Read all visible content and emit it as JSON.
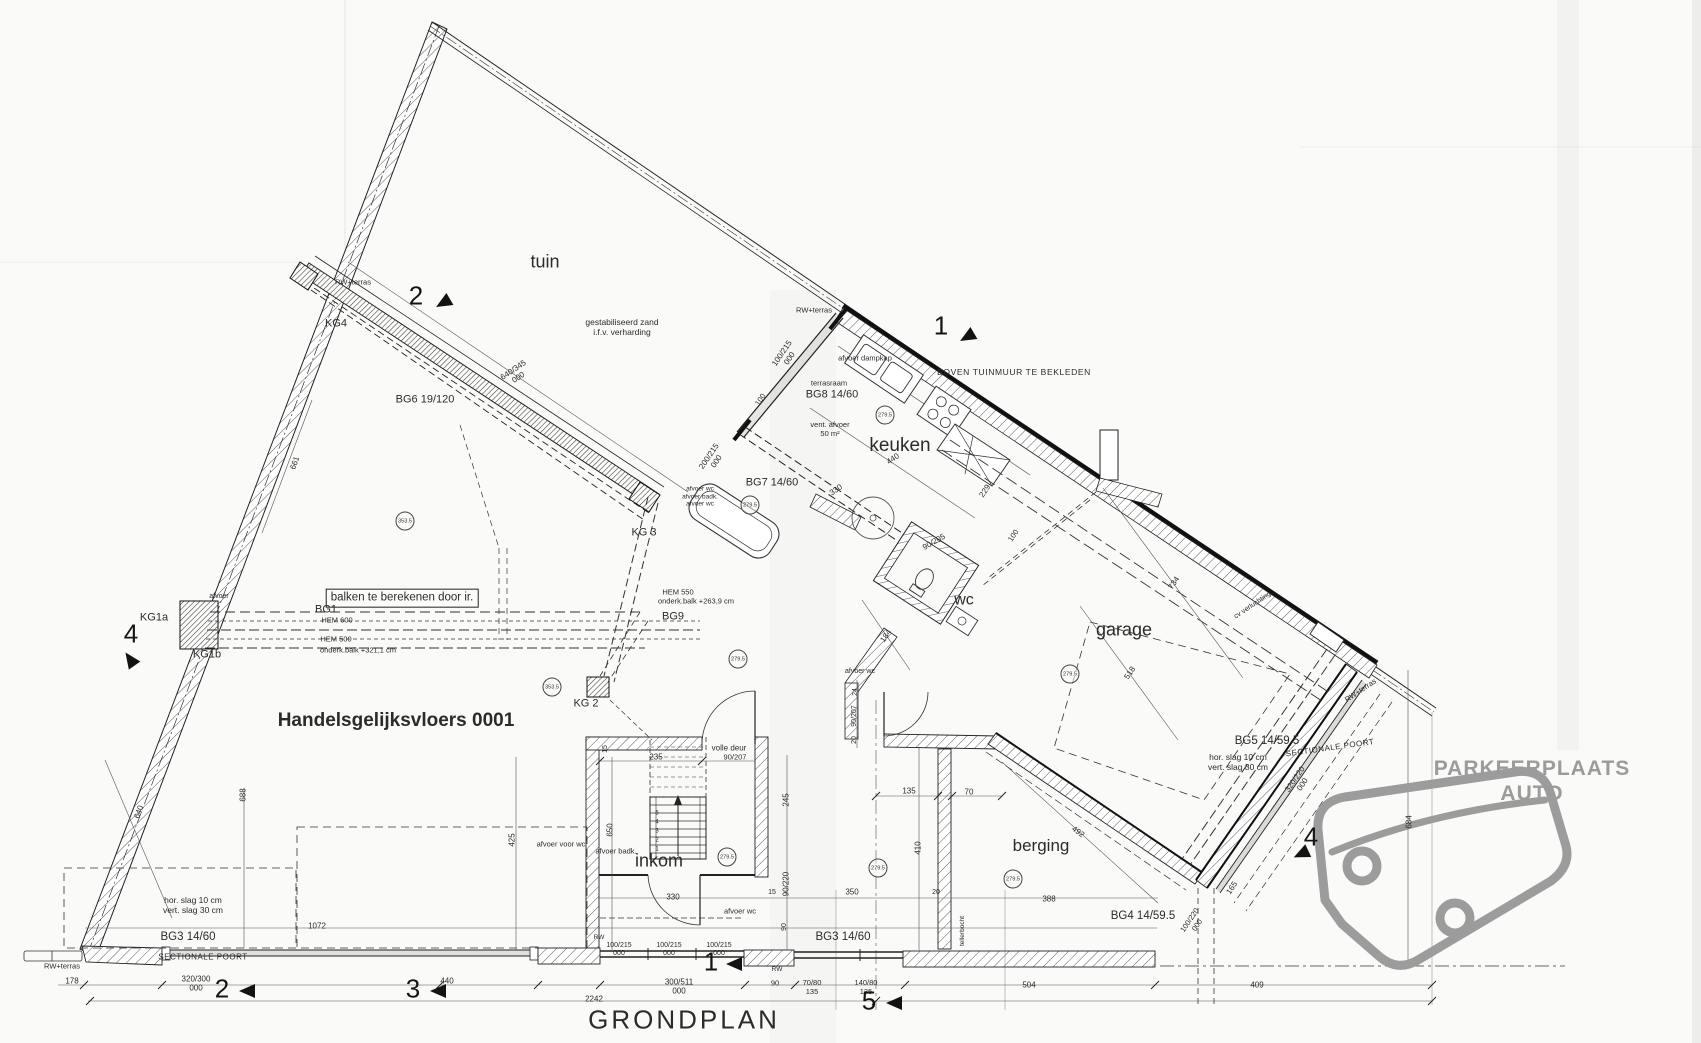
{
  "colors": {
    "ink": "#2a2a2a",
    "gray_text": "#9b9b9b",
    "paper": "#fafaf8",
    "car_outline": "#9c9c9c"
  },
  "labels": [
    {
      "n": "room-label-tuin",
      "t": "tuin",
      "x": 545,
      "y": 262,
      "s": 18
    },
    {
      "n": "room-label-keuken",
      "t": "keuken",
      "x": 900,
      "y": 446,
      "s": 19
    },
    {
      "n": "room-label-wc",
      "t": "wc",
      "x": 964,
      "y": 601,
      "s": 16
    },
    {
      "n": "room-label-garage",
      "t": "garage",
      "x": 1124,
      "y": 630,
      "s": 18
    },
    {
      "n": "room-label-berging",
      "t": "berging",
      "x": 1041,
      "y": 846,
      "s": 17
    },
    {
      "n": "room-label-inkom",
      "t": "inkom",
      "x": 659,
      "y": 861,
      "s": 18
    },
    {
      "n": "floor-title",
      "t": "Handelsgelijksvloers 0001",
      "x": 396,
      "y": 721,
      "s": 19,
      "w": 700
    },
    {
      "n": "plan-title",
      "t": "GRONDPLAN",
      "x": 684,
      "y": 1020,
      "s": 26,
      "ls": 3
    },
    {
      "n": "parking-label",
      "t": "PARKEERPLAATS AUTO",
      "x": 1532,
      "y": 782,
      "s": 21,
      "w": 700,
      "c": "#9b9b9b",
      "ls": 1
    },
    {
      "n": "note-gestabiliseerd-zand",
      "t": "gestabiliseerd zand\ni.f.v. verharding",
      "x": 622,
      "y": 327,
      "s": 8.5
    },
    {
      "n": "note-tuinmuur",
      "t": "BOVEN TUINMUUR TE BEKLEDEN",
      "x": 1014,
      "y": 372,
      "s": 8.5,
      "ls": 0.6
    },
    {
      "n": "note-balken",
      "t": "balken te berekenen door ir.",
      "x": 402,
      "y": 598,
      "s": 11.5,
      "box": true
    },
    {
      "n": "note-slag-left",
      "t": "hor. slag 10 cm\nvert. slag 30 cm",
      "x": 193,
      "y": 905,
      "s": 8.5
    },
    {
      "n": "note-slag-right",
      "t": "hor. slag 10 cm\nvert. slag 30 cm",
      "x": 1238,
      "y": 762,
      "s": 8.5
    },
    {
      "n": "note-volle-deur",
      "t": "volle deur",
      "x": 729,
      "y": 748,
      "s": 8
    },
    {
      "n": "note-onderkant-balk-1",
      "t": "onderk.balk +321,1 cm",
      "x": 358,
      "y": 651,
      "s": 7.5
    },
    {
      "n": "note-onderkant-balk-2",
      "t": "onderk.balk +263,9 cm",
      "x": 696,
      "y": 602,
      "s": 7.5
    },
    {
      "n": "beam-hem600",
      "t": "HEM 600",
      "x": 337,
      "y": 621,
      "s": 7.5
    },
    {
      "n": "beam-hem500",
      "t": "HEM 500",
      "x": 336,
      "y": 640,
      "s": 7.5
    },
    {
      "n": "beam-hem550",
      "t": "HEM 550",
      "x": 678,
      "y": 593,
      "s": 7.5
    },
    {
      "n": "note-sectionale-poort-left",
      "t": "SECTIONALE POORT",
      "x": 203,
      "y": 957,
      "s": 8,
      "ls": 0.5
    },
    {
      "n": "note-sectionale-poort-right",
      "t": "SECTIONALE POORT",
      "x": 1330,
      "y": 748,
      "s": 8,
      "r": -8,
      "ls": 0.5
    },
    {
      "n": "note-tellerbocht",
      "t": "tellerbocht",
      "x": 963,
      "y": 931,
      "s": 6.5,
      "r": -90
    },
    {
      "n": "note-cv-verluchting",
      "t": "cv verluchting",
      "x": 1253,
      "y": 606,
      "s": 7,
      "r": -34
    },
    {
      "n": "note-rw-terras-1",
      "t": "RW+terras",
      "x": 353,
      "y": 283,
      "s": 7.5
    },
    {
      "n": "note-rw-terras-2",
      "t": "RW+terras",
      "x": 814,
      "y": 311,
      "s": 7.5
    },
    {
      "n": "note-rw-terras-3",
      "t": "RW+terras",
      "x": 62,
      "y": 967,
      "s": 7.5
    },
    {
      "n": "note-rw-terras-4",
      "t": "RW+terras",
      "x": 1361,
      "y": 691,
      "s": 7.5,
      "r": -34
    },
    {
      "n": "note-rw-1",
      "t": "RW",
      "x": 599,
      "y": 938,
      "s": 6.5
    },
    {
      "n": "note-rw-2",
      "t": "RW",
      "x": 777,
      "y": 970,
      "s": 6.5
    },
    {
      "n": "column-kg4",
      "t": "KG4",
      "x": 336,
      "y": 324,
      "s": 11
    },
    {
      "n": "column-kg3",
      "t": "KG 3",
      "x": 644,
      "y": 533,
      "s": 11
    },
    {
      "n": "column-kg2",
      "t": "KG 2",
      "x": 586,
      "y": 704,
      "s": 11
    },
    {
      "n": "column-kg1a",
      "t": "KG1a",
      "x": 154,
      "y": 618,
      "s": 11
    },
    {
      "n": "column-kg1b",
      "t": "KG1b",
      "x": 207,
      "y": 655,
      "s": 11
    },
    {
      "n": "beam-bg6",
      "t": "BG6 19/120",
      "x": 425,
      "y": 400,
      "s": 11
    },
    {
      "n": "beam-bg7",
      "t": "BG7 14/60",
      "x": 772,
      "y": 483,
      "s": 11
    },
    {
      "n": "beam-bg8",
      "t": "BG8 14/60",
      "x": 832,
      "y": 395,
      "s": 11
    },
    {
      "n": "beam-bg1",
      "t": "BG1",
      "x": 326,
      "y": 610,
      "s": 11
    },
    {
      "n": "beam-bg9",
      "t": "BG9",
      "x": 673,
      "y": 617,
      "s": 11
    },
    {
      "n": "beam-bg3-left",
      "t": "BG3 14/60",
      "x": 188,
      "y": 938,
      "s": 11.5
    },
    {
      "n": "beam-bg3-mid",
      "t": "BG3 14/60",
      "x": 843,
      "y": 938,
      "s": 11.5
    },
    {
      "n": "beam-bg4",
      "t": "BG4 14/59.5",
      "x": 1143,
      "y": 917,
      "s": 11.5
    },
    {
      "n": "beam-bg5",
      "t": "BG5 14/59.5",
      "x": 1267,
      "y": 742,
      "s": 11.5
    },
    {
      "n": "note-afvoer-dampkap",
      "t": "afvoer dampkap",
      "x": 865,
      "y": 359,
      "s": 7.5
    },
    {
      "n": "note-terrasraam",
      "t": "terrasraam",
      "x": 829,
      "y": 384,
      "s": 7.5
    },
    {
      "n": "note-vent-afvoer",
      "t": "vent. afvoer\n50 m²",
      "x": 830,
      "y": 430,
      "s": 7.5
    },
    {
      "n": "note-afvoer-kg1",
      "t": "afvoer",
      "x": 219,
      "y": 597,
      "s": 7
    },
    {
      "n": "note-afvoer-voor-wc",
      "t": "afvoer voor wc",
      "x": 561,
      "y": 845,
      "s": 7.5
    },
    {
      "n": "note-afvoer-badk",
      "t": "afvoer badk.",
      "x": 616,
      "y": 852,
      "s": 7.5
    },
    {
      "n": "note-afvoer-wc-1",
      "t": "afvoer wc",
      "x": 740,
      "y": 912,
      "s": 7.5
    },
    {
      "n": "note-afvoer-wc-2",
      "t": "afvoer wc",
      "x": 860,
      "y": 672,
      "s": 7
    },
    {
      "n": "note-afvoer-stack",
      "t": "afvoer wc\nafvoer badk.\nafvoer wc",
      "x": 700,
      "y": 497,
      "s": 6.5
    },
    {
      "n": "dim-640-345",
      "t": "640/345\n000",
      "x": 516,
      "y": 374,
      "s": 8,
      "r": -34
    },
    {
      "n": "dim-100-215-top",
      "t": "100/215\n000",
      "x": 786,
      "y": 356,
      "s": 8,
      "r": -56
    },
    {
      "n": "dim-100-a",
      "t": "100",
      "x": 761,
      "y": 400,
      "s": 7.5,
      "r": -56
    },
    {
      "n": "dim-200-215",
      "t": "200/215\n000",
      "x": 713,
      "y": 459,
      "s": 8,
      "r": -56
    },
    {
      "n": "dim-440-keuken",
      "t": "440",
      "x": 893,
      "y": 459,
      "s": 8,
      "r": -34
    },
    {
      "n": "dim-330-keuken",
      "t": "330",
      "x": 836,
      "y": 490,
      "s": 8,
      "r": -34
    },
    {
      "n": "dim-330-inkom",
      "t": "330",
      "x": 673,
      "y": 897,
      "s": 8
    },
    {
      "n": "dim-229",
      "t": "229",
      "x": 985,
      "y": 491,
      "s": 8,
      "r": -56
    },
    {
      "n": "dim-100-b",
      "t": "100",
      "x": 1014,
      "y": 536,
      "s": 7.5,
      "r": -56
    },
    {
      "n": "dim-90-205",
      "t": "90/205",
      "x": 934,
      "y": 542,
      "s": 8,
      "r": -30
    },
    {
      "n": "dim-184",
      "t": "184",
      "x": 886,
      "y": 636,
      "s": 8,
      "r": -56
    },
    {
      "n": "dim-734",
      "t": "734",
      "x": 1174,
      "y": 583,
      "s": 8,
      "r": -56
    },
    {
      "n": "dim-518",
      "t": "518",
      "x": 1130,
      "y": 673,
      "s": 8,
      "r": -56
    },
    {
      "n": "dim-492",
      "t": "492",
      "x": 1078,
      "y": 832,
      "s": 8,
      "r": 36
    },
    {
      "n": "dim-165",
      "t": "165",
      "x": 1232,
      "y": 888,
      "s": 8,
      "r": -56
    },
    {
      "n": "dim-100-220",
      "t": "100/220\n000",
      "x": 1194,
      "y": 923,
      "s": 7.5,
      "r": -56
    },
    {
      "n": "dim-320-220",
      "t": "320/220\n000",
      "x": 1299,
      "y": 782,
      "s": 8,
      "r": -56
    },
    {
      "n": "dim-684",
      "t": "684",
      "x": 1409,
      "y": 822,
      "s": 8,
      "r": -90
    },
    {
      "n": "dim-661",
      "t": "661",
      "x": 295,
      "y": 463,
      "s": 8,
      "r": -70
    },
    {
      "n": "dim-640",
      "t": "640",
      "x": 139,
      "y": 812,
      "s": 8,
      "r": -70
    },
    {
      "n": "dim-688",
      "t": "688",
      "x": 243,
      "y": 795,
      "s": 8,
      "r": -90
    },
    {
      "n": "dim-425",
      "t": "425",
      "x": 512,
      "y": 840,
      "s": 8,
      "r": -90
    },
    {
      "n": "dim-650",
      "t": "650",
      "x": 610,
      "y": 830,
      "s": 8,
      "r": -90
    },
    {
      "n": "dim-245",
      "t": "245",
      "x": 786,
      "y": 800,
      "s": 8,
      "r": -90
    },
    {
      "n": "dim-90-220",
      "t": "90/220",
      "x": 786,
      "y": 884,
      "s": 8,
      "r": -90
    },
    {
      "n": "dim-90-c",
      "t": "90",
      "x": 785,
      "y": 927,
      "s": 7,
      "r": -90
    },
    {
      "n": "dim-15-a",
      "t": "15",
      "x": 772,
      "y": 893,
      "s": 7
    },
    {
      "n": "dim-15-b",
      "t": "15",
      "x": 606,
      "y": 749,
      "s": 7,
      "r": -90
    },
    {
      "n": "dim-235",
      "t": "235",
      "x": 656,
      "y": 757,
      "s": 8
    },
    {
      "n": "dim-90-207-deur",
      "t": "90/207",
      "x": 735,
      "y": 758,
      "s": 7.5
    },
    {
      "n": "dim-410",
      "t": "410",
      "x": 918,
      "y": 848,
      "s": 8,
      "r": -90
    },
    {
      "n": "dim-350",
      "t": "350",
      "x": 852,
      "y": 892,
      "s": 8
    },
    {
      "n": "dim-20-a",
      "t": "20",
      "x": 936,
      "y": 893,
      "s": 7
    },
    {
      "n": "dim-388",
      "t": "388",
      "x": 1049,
      "y": 899,
      "s": 8
    },
    {
      "n": "dim-135",
      "t": "135",
      "x": 909,
      "y": 791,
      "s": 8
    },
    {
      "n": "dim-70",
      "t": "70",
      "x": 969,
      "y": 792,
      "s": 8
    },
    {
      "n": "dim-24",
      "t": "24",
      "x": 856,
      "y": 692,
      "s": 7,
      "r": -90
    },
    {
      "n": "dim-90-207-side",
      "t": "90/207",
      "x": 855,
      "y": 716,
      "s": 7,
      "r": -90
    },
    {
      "n": "dim-20-b",
      "t": "20",
      "x": 855,
      "y": 740,
      "s": 7,
      "r": -90
    },
    {
      "n": "dim-1072",
      "t": "1072",
      "x": 317,
      "y": 926,
      "s": 8
    },
    {
      "n": "dim-178",
      "t": "178",
      "x": 72,
      "y": 981,
      "s": 8
    },
    {
      "n": "dim-320-300",
      "t": "320/300\n000",
      "x": 196,
      "y": 984,
      "s": 8
    },
    {
      "n": "dim-440-b",
      "t": "440",
      "x": 447,
      "y": 981,
      "s": 8
    },
    {
      "n": "dim-300-511",
      "t": "300/511\n000",
      "x": 679,
      "y": 987,
      "s": 8
    },
    {
      "n": "dim-90-d",
      "t": "90",
      "x": 775,
      "y": 984,
      "s": 7.5
    },
    {
      "n": "dim-70-80",
      "t": "70/80\n135",
      "x": 812,
      "y": 988,
      "s": 7.5
    },
    {
      "n": "dim-140-80",
      "t": "140/80\n135",
      "x": 866,
      "y": 988,
      "s": 7.5
    },
    {
      "n": "dim-504",
      "t": "504",
      "x": 1029,
      "y": 985,
      "s": 8
    },
    {
      "n": "dim-409",
      "t": "409",
      "x": 1257,
      "y": 985,
      "s": 8
    },
    {
      "n": "dim-2242",
      "t": "2242",
      "x": 594,
      "y": 999,
      "s": 8
    },
    {
      "n": "dim-100-215-w1",
      "t": "100/215\n000",
      "x": 619,
      "y": 950,
      "s": 7
    },
    {
      "n": "dim-100-215-w2",
      "t": "100/215\n000",
      "x": 669,
      "y": 950,
      "s": 7
    },
    {
      "n": "dim-100-215-w3",
      "t": "100/215\n000",
      "x": 719,
      "y": 950,
      "s": 7
    },
    {
      "n": "stair-step-1",
      "t": "1",
      "x": 657,
      "y": 850,
      "s": 6
    },
    {
      "n": "stair-step-2",
      "t": "2",
      "x": 657,
      "y": 841,
      "s": 6
    },
    {
      "n": "stair-step-3",
      "t": "3",
      "x": 657,
      "y": 832,
      "s": 6
    },
    {
      "n": "stair-step-4",
      "t": "4",
      "x": 657,
      "y": 823,
      "s": 6
    },
    {
      "n": "stair-step-5",
      "t": "5",
      "x": 657,
      "y": 814,
      "s": 6
    }
  ],
  "level_markers": [
    {
      "t": "279.5",
      "x": 885,
      "y": 415
    },
    {
      "t": "279.5",
      "x": 750,
      "y": 505
    },
    {
      "t": "279.5",
      "x": 738,
      "y": 659
    },
    {
      "t": "279.5",
      "x": 1070,
      "y": 674
    },
    {
      "t": "279.5",
      "x": 727,
      "y": 857
    },
    {
      "t": "279.5",
      "x": 878,
      "y": 868
    },
    {
      "t": "279.5",
      "x": 1013,
      "y": 879
    },
    {
      "t": "353.5",
      "x": 405,
      "y": 521
    },
    {
      "t": "353.5",
      "x": 552,
      "y": 687
    }
  ],
  "section_markers": [
    {
      "d": "2",
      "x": 416,
      "y": 296,
      "tx": 443,
      "ty": 303,
      "tr": -30
    },
    {
      "d": "1",
      "x": 941,
      "y": 326,
      "tx": 967,
      "ty": 337,
      "tr": -30
    },
    {
      "d": "4",
      "x": 131,
      "y": 634,
      "tx": 130,
      "ty": 659,
      "tr": 55
    },
    {
      "d": "4",
      "x": 1311,
      "y": 837,
      "tx": 1301,
      "ty": 854,
      "tr": -25
    },
    {
      "d": "2",
      "x": 222,
      "y": 989,
      "tx": 247,
      "ty": 991,
      "tr": 0
    },
    {
      "d": "3",
      "x": 413,
      "y": 989,
      "tx": 438,
      "ty": 991,
      "tr": 0
    },
    {
      "d": "1",
      "x": 711,
      "y": 962,
      "tx": 734,
      "ty": 964,
      "tr": 0
    },
    {
      "d": "5",
      "x": 869,
      "y": 1001,
      "tx": 894,
      "ty": 1003,
      "tr": 0
    }
  ]
}
